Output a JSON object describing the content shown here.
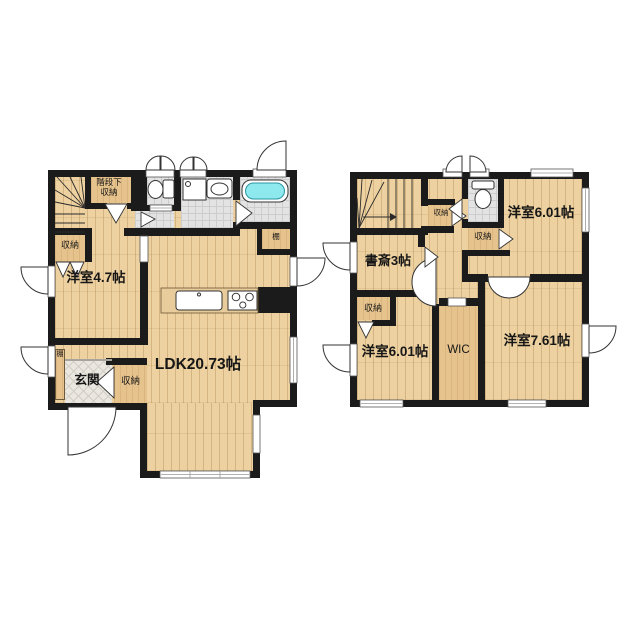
{
  "floor1": {
    "stair_storage_line1": "階段下",
    "stair_storage_line2": "収納",
    "closet_a": "収納",
    "bedroom": "洋室4.7帖",
    "shelf_right": "棚",
    "ldk": "LDK20.73帖",
    "genkan": "玄関",
    "entry_closet": "収納",
    "shelf_left": "棚"
  },
  "floor2": {
    "stair_closet": "収納",
    "study": "書斎3帖",
    "left_closet": "収納",
    "bedroom_ne": "洋室6.01帖",
    "wc_closet": "収納",
    "bedroom_sw": "洋室6.01帖",
    "wic": "WIC",
    "bedroom_se": "洋室7.61帖"
  },
  "colors": {
    "wall": "#1b1b1b",
    "wood": "#edd1a0",
    "tan": "#e6c28c",
    "tile": "#e3e3e3",
    "tub": "#8ee9ee",
    "background": "#ffffff"
  }
}
